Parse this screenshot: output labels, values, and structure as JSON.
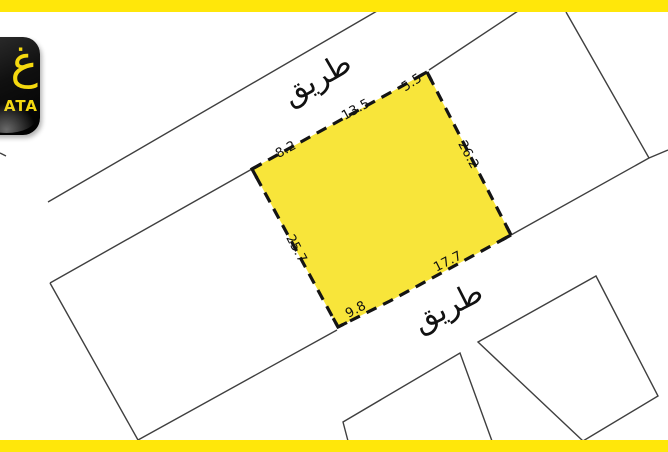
{
  "map": {
    "road_top": {
      "label": "طريق"
    },
    "road_bottom": {
      "label": "طريق"
    },
    "highlight_plot": {
      "measurements": [
        {
          "edge": "top-left",
          "value": "8.2"
        },
        {
          "edge": "top-middle",
          "value": "13.5"
        },
        {
          "edge": "top-right",
          "value": "5.5"
        },
        {
          "edge": "right",
          "value": "26.2"
        },
        {
          "edge": "bottom-right",
          "value": "17.7"
        },
        {
          "edge": "bottom-left",
          "value": "9.8"
        },
        {
          "edge": "left",
          "value": "25.7"
        }
      ]
    },
    "colors": {
      "highlight": "#F8E53A",
      "accent_bar": "#FFE70A",
      "boundary_line": "#3F3F3F",
      "plot_dash": "#141414",
      "label": "#111111"
    }
  },
  "logo": {
    "glyph": "غ",
    "brand_suffix": "ATA"
  }
}
